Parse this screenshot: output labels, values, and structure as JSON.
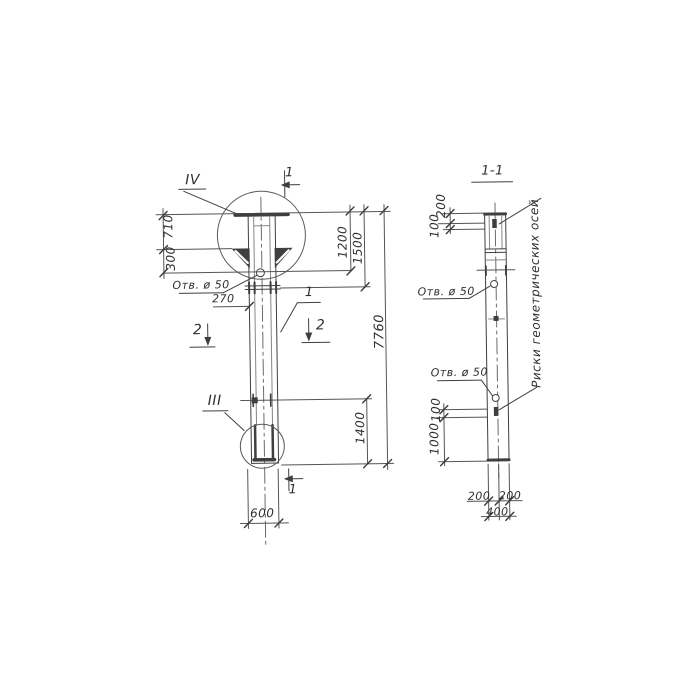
{
  "meta": {
    "background_color": "#ffffff",
    "ink_color": "#3f3f3f",
    "drawing_type": "technical drawing, scanned hand-drawn column elevation and section"
  },
  "left_view": {
    "detail_top_label": "IV",
    "detail_bottom_label": "III",
    "section_cut_1": "1",
    "section_cut_2": "2",
    "part_callout": "1",
    "hole_label": "Отв. ø 50",
    "dims": {
      "plate_to_bracket": "710",
      "bracket_to_hole": "300",
      "hole_offset": "270",
      "top_to_hole": "1200",
      "top_to_joint": "1500",
      "total_height": "7760",
      "joint_to_bottom": "1400",
      "width": "600"
    }
  },
  "section_view": {
    "title": "1-1",
    "hole_label_upper": "Отв. ø 50",
    "hole_label_lower": "Отв. ø 50",
    "axis_note": "Риски геометрических осей",
    "dims": {
      "top_to_mark": "200",
      "mark_top": "100",
      "mark_bottom": "100",
      "mark_to_end": "1000",
      "half_width_left": "200",
      "half_width_right": "200",
      "width": "400"
    }
  }
}
